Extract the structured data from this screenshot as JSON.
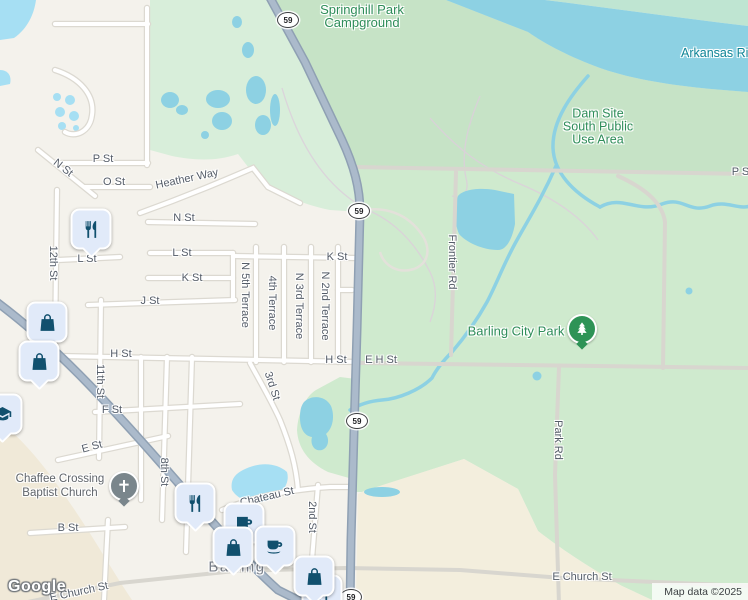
{
  "map": {
    "shield": "59",
    "city": "Barling",
    "attribution": "Map data ©2025",
    "google": "Google"
  },
  "streets": {
    "p_st_w": "P St",
    "p_st_e": "P St",
    "o_st": "O St",
    "n_st_diag": "N St",
    "n_st": "N St",
    "heather_way": "Heather Way",
    "l_st_e": "L St",
    "l_st_w": "L St",
    "k_st_w": "K St",
    "k_st_e": "K St",
    "j_st": "J St",
    "h_st_w": "H St",
    "h_st_e": "H St",
    "e_h_st": "E H St",
    "f_st": "F St",
    "e_st": "E St",
    "b_st": "B St",
    "chateau_st": "Chateau St",
    "e_church_st_w": "E Church St",
    "e_church_st_e": "E Church St",
    "st_12": "12th St",
    "st_11": "11th St",
    "st_8": "8th St",
    "ter_5": "N 5th Terrace",
    "ter_4": "4th Terrace",
    "ter_3": "N 3rd Terrace",
    "ter_2": "N 2nd Terrace",
    "st_3": "3rd St",
    "st_2": "2nd St",
    "frontier_rd": "Frontier Rd",
    "park_rd": "Park Rd"
  },
  "places": {
    "springhill": {
      "line1": "Springhill Park",
      "line2": "Campground"
    },
    "dam_site": {
      "line1": "Dam Site",
      "line2": "South Public",
      "line3": "Use Area"
    },
    "river": "Arkansas Riv",
    "city_park": "Barling City Park",
    "church": {
      "line1": "Chaffee Crossing",
      "line2": "Baptist Church"
    }
  },
  "icons": [
    "restaurant-icon",
    "shopping-bag-icon",
    "coffee-cup-icon",
    "mug-icon",
    "school-icon",
    "church-icon",
    "tree-icon"
  ],
  "colors": {
    "park_green": "#cfeace",
    "campground_green": "#c6e3c6",
    "nw_green": "#d8eeda",
    "river_blue": "#8dd1e3",
    "town_pond_blue": "#a6dff3",
    "cream": "#f3eedd",
    "tan": "#f0e9d8",
    "town_bg": "#f4f2ec",
    "highway_fill": "#abbacb",
    "highway_casing": "#8fa0b3",
    "pin_fill": "#e1eaf9",
    "pin_icon": "#11506e",
    "label_green": "#2e8d59",
    "label_water": "#0e8496",
    "label_street": "#545c68"
  }
}
